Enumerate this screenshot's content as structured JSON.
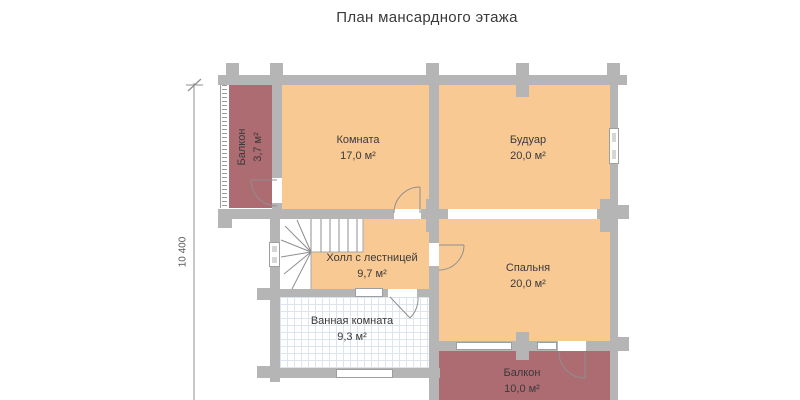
{
  "title": "План мансардного этажа",
  "dimension_label": "10 400",
  "rooms": {
    "balcony_top": {
      "name": "Балкон",
      "area": "3,7 м²"
    },
    "room": {
      "name": "Комната",
      "area": "17,0 м²"
    },
    "boudoir": {
      "name": "Будуар",
      "area": "20,0 м²"
    },
    "hall": {
      "name": "Холл с лестницей",
      "area": "9,7 м²"
    },
    "bedroom": {
      "name": "Спальня",
      "area": "20,0 м²"
    },
    "bathroom": {
      "name": "Ванная комната",
      "area": "9,3 м²"
    },
    "balcony_bottom": {
      "name": "Балкон",
      "area": "10,0 м²"
    }
  },
  "colors": {
    "wall": "#b5b5b5",
    "room_fill": "#f9c994",
    "balcony_fill": "#ad6b72",
    "tile_line": "#dce5ee",
    "line": "#8f8f8f",
    "text": "#3a3a3a"
  }
}
